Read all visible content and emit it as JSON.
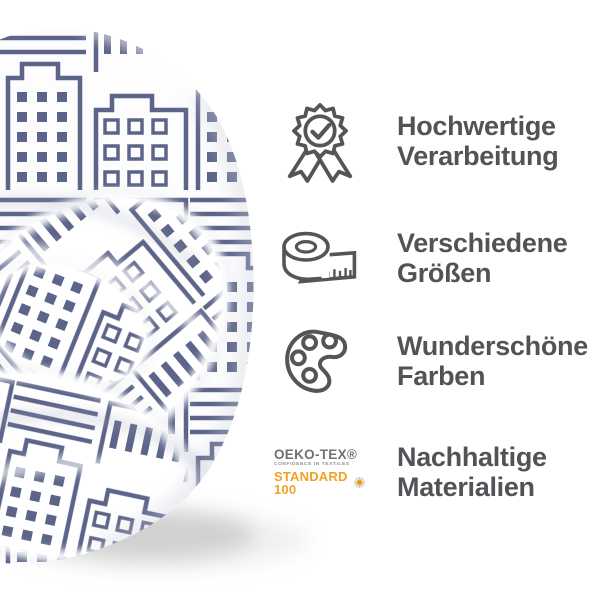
{
  "image": {
    "type": "bedding product feature graphic",
    "background": "#ffffff"
  },
  "duvet": {
    "description": "rolled white duvet with slate-blue city skyline line-art pattern",
    "fabric_color": "#ffffff",
    "pattern_color": "#5c6589",
    "pattern_motif": "city buildings outlines with square windows, stripes and bars"
  },
  "features": [
    {
      "icon": "award-badge",
      "lines": [
        "Hochwertige",
        "Verarbeitung"
      ]
    },
    {
      "icon": "measuring-tape",
      "lines": [
        "Verschiedene",
        "Größen"
      ]
    },
    {
      "icon": "paint-palette",
      "lines": [
        "Wunderschöne",
        "Farben"
      ]
    },
    {
      "icon": "oeko-tex-label",
      "lines": [
        "Nachhaltige",
        "Materialien"
      ]
    }
  ],
  "oeko_tex": {
    "brand": "OEKO-TEX®",
    "tagline": "CONFIDENCE IN TEXTILES",
    "standard": "STANDARD 100"
  },
  "colors": {
    "heading_text": "#525356",
    "icon_stroke": "#555557",
    "oeko_orange": "#f0a226",
    "oeko_gray": "#707173",
    "pattern_slate": "#5c6589"
  }
}
